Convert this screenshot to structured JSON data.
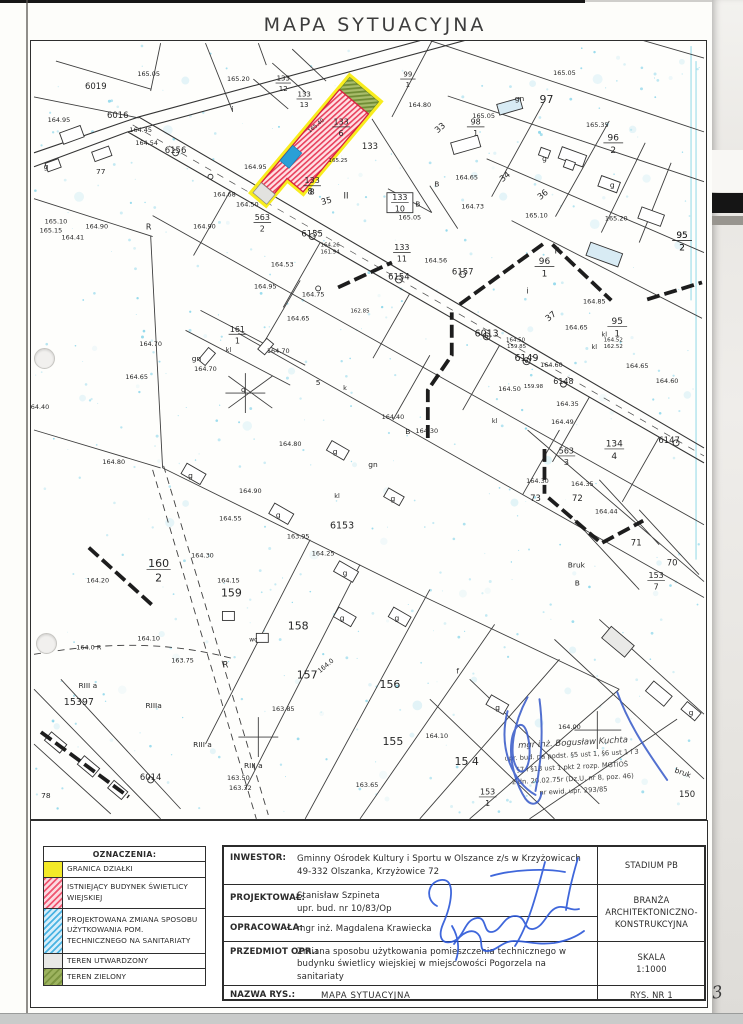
{
  "page": {
    "title": "MAPA SYTUACYJNA",
    "page_number": "3"
  },
  "legend": {
    "header": "OZNACZENIA:",
    "items": [
      {
        "label": "GRANICA DZIAŁKI",
        "swatch": "yellow",
        "color": "#f3e927"
      },
      {
        "label": "ISTNIEJĄCY BUDYNEK ŚWIETLICY WIEJSKIEJ",
        "swatch": "red",
        "color": "#ef5570"
      },
      {
        "label": "PROJEKTOWANA ZMIANA SPOSOBU UŻYTKOWANIA POM. TECHNICZNEGO NA SANITARIATY",
        "swatch": "blue",
        "color": "#4ab3e2"
      },
      {
        "label": "TEREN UTWARDZONY",
        "swatch": "gray",
        "color": "#e8e8e6"
      },
      {
        "label": "TEREN ZIELONY",
        "swatch": "green",
        "color": "#8fa750"
      }
    ]
  },
  "title_block": {
    "inwestor": {
      "label": "INWESTOR:",
      "line1": "Gminny Ośrodek Kultury i Sportu w Olszance z/s w Krzyżowicach",
      "line2": "49-332 Olszanka, Krzyżowice 72"
    },
    "stadium": "STADIUM PB",
    "projektowal": {
      "label": "PROJEKTOWAŁ:",
      "name": "Stanisław Szpineta",
      "upr": "upr. bud. nr 10/83/Op"
    },
    "opracowala": {
      "label": "OPRACOWAŁA:",
      "name": "mgr inż. Magdalena Krawiecka"
    },
    "branza": "BRANŻA\nARCHITEKTONICZNO-\nKONSTRUKCYJNA",
    "przedmiot": {
      "label": "PRZEDMIOT OPR.:",
      "value": "Zmiana sposobu użytkowania pomieszczenia technicznego w\nbudynku świetlicy wiejskiej w miejscowości Pogorzela na\nsanitariaty"
    },
    "skala": {
      "label": "SKALA",
      "value": "1:1000"
    },
    "nazwa": {
      "label": "NAZWA RYS.:",
      "value": "MAPA SYTUACYJNA"
    },
    "rys_nr": "RYS. NR 1"
  },
  "stamp": {
    "color": "#3a5cc4",
    "name": "mgr inż. Bogusław Kuchta",
    "lines": [
      "upr. bud. na podst. §5 ust 1, §6 ust 1 i 3",
      "§7 i §13 ust 1 pkt 2 rozp. MGTiOŚ",
      "z dn. 20.02.75r (Dz.U. nr 8, poz. 46)",
      "nr ewid. upr. 293/85"
    ]
  },
  "map": {
    "labels": [
      [
        "165.05",
        148,
        75,
        6.5
      ],
      [
        "165.20",
        238,
        80,
        6.5
      ],
      [
        "6019",
        95,
        88,
        8.5
      ],
      [
        "6016",
        117,
        117,
        8.5
      ],
      [
        "164.95",
        58,
        121,
        6.5
      ],
      [
        "164.45",
        140,
        131,
        6.5
      ],
      [
        "164.54",
        146,
        144,
        6.5
      ],
      [
        "6156",
        175,
        152,
        8.5
      ],
      [
        "164.95",
        255,
        168,
        6.5
      ],
      [
        "164.68",
        224,
        196,
        6.5
      ],
      [
        "164.50",
        247,
        206,
        6.5
      ],
      [
        "164.90",
        96,
        228,
        6.5
      ],
      [
        "R",
        148,
        229,
        8
      ],
      [
        "164.90",
        204,
        228,
        6.5
      ],
      [
        "165.10",
        55,
        223,
        6.5
      ],
      [
        "165.15",
        50,
        232,
        6.5
      ],
      [
        "164.41",
        72,
        239,
        6.5
      ],
      [
        "164.75",
        313,
        296,
        6.5
      ],
      [
        "164.95",
        265,
        288,
        6.5
      ],
      [
        "164.53",
        282,
        266,
        6.5
      ],
      [
        "6155",
        312,
        236,
        8.5
      ],
      [
        "B",
        418,
        206,
        7.5
      ],
      [
        "165.05",
        410,
        219,
        6.5
      ],
      [
        "8",
        310,
        194,
        8.5
      ],
      [
        "35",
        327,
        203,
        8.5,
        -15
      ],
      [
        "II",
        346,
        198,
        8.5
      ],
      [
        "164.26",
        330,
        246,
        5.5
      ],
      [
        "161.94",
        330,
        253,
        5.5
      ],
      [
        "165.40",
        317,
        126,
        5.5,
        -40
      ],
      [
        "133",
        370,
        148,
        8.5
      ],
      [
        "165.25",
        338,
        161,
        5.5
      ],
      [
        "i",
        232,
        111,
        8
      ],
      [
        "77",
        100,
        173,
        7.5
      ],
      [
        "g",
        45,
        168,
        7.5
      ],
      [
        "97",
        547,
        102,
        11
      ],
      [
        "gn",
        520,
        100,
        7.5
      ],
      [
        "165.05",
        484,
        117,
        6.5
      ],
      [
        "165.05",
        565,
        74,
        6.5
      ],
      [
        "33",
        442,
        129,
        8.5,
        -40
      ],
      [
        "165.35",
        598,
        126,
        6.5
      ],
      [
        "34",
        507,
        178,
        8.5,
        -40
      ],
      [
        "36",
        545,
        196,
        8.5,
        -40
      ],
      [
        "165.10",
        537,
        217,
        6.5
      ],
      [
        "165.20",
        617,
        220,
        6.5
      ],
      [
        "164.65",
        467,
        179,
        6.5
      ],
      [
        "164.73",
        473,
        208,
        6.5
      ],
      [
        "B",
        437,
        186,
        7.5
      ],
      [
        "164.80",
        420,
        106,
        6.5
      ],
      [
        "R",
        558,
        253,
        8.5
      ],
      [
        "i",
        528,
        293,
        8
      ],
      [
        "37",
        553,
        318,
        8.5,
        -40
      ],
      [
        "164.85",
        595,
        303,
        6.5
      ],
      [
        "164.65",
        577,
        329,
        6.5
      ],
      [
        "kl",
        605,
        336,
        6.5
      ],
      [
        "kl",
        595,
        349,
        6.5
      ],
      [
        "164.52",
        614,
        341,
        5.5
      ],
      [
        "162.52",
        614,
        348,
        5.5
      ],
      [
        "164.65",
        638,
        368,
        6.5
      ],
      [
        "164.60",
        668,
        383,
        6.5
      ],
      [
        "6013",
        487,
        336,
        9.5
      ],
      [
        "6149",
        527,
        361,
        9.5
      ],
      [
        "164.60",
        552,
        367,
        6.5
      ],
      [
        "164.50",
        516,
        341,
        5.5
      ],
      [
        "159.85",
        517,
        348,
        5.5
      ],
      [
        "164.50",
        510,
        391,
        6.5
      ],
      [
        "159.98",
        534,
        388,
        5.5
      ],
      [
        "6148",
        564,
        384,
        8
      ],
      [
        "164.35",
        568,
        406,
        6.5
      ],
      [
        "164.49",
        563,
        424,
        6.5
      ],
      [
        "164.40",
        393,
        419,
        6.5
      ],
      [
        "164.30",
        427,
        433,
        6.5
      ],
      [
        "kl",
        495,
        423,
        6.5
      ],
      [
        "B",
        408,
        434,
        7.5
      ],
      [
        "6154",
        399,
        279,
        8.5
      ],
      [
        "6157",
        463,
        274,
        8.5
      ],
      [
        "164.56",
        436,
        262,
        6.5
      ],
      [
        "6153",
        342,
        529,
        9.5
      ],
      [
        "163.95",
        298,
        539,
        6.5
      ],
      [
        "164.25",
        323,
        556,
        6.5
      ],
      [
        "164.30",
        202,
        558,
        6.5
      ],
      [
        "164.20",
        97,
        583,
        6.5
      ],
      [
        "164.15",
        228,
        583,
        6.5
      ],
      [
        "159",
        231,
        597,
        11
      ],
      [
        "158",
        298,
        630,
        11
      ],
      [
        "157",
        307,
        679,
        11
      ],
      [
        "156",
        390,
        689,
        11
      ],
      [
        "155",
        393,
        746,
        11
      ],
      [
        "15 4",
        467,
        766,
        11
      ],
      [
        "150",
        688,
        798,
        8.5
      ],
      [
        "bruk",
        683,
        776,
        7.5,
        20
      ],
      [
        "Bruk",
        577,
        568,
        7.5
      ],
      [
        "164.80",
        113,
        464,
        6.5
      ],
      [
        "164.80",
        290,
        446,
        6.5
      ],
      [
        "164.90",
        250,
        493,
        6.5
      ],
      [
        "164.55",
        230,
        521,
        6.5
      ],
      [
        "164.10",
        148,
        641,
        6.5
      ],
      [
        "164.0 R",
        88,
        650,
        6.5
      ],
      [
        "163.75",
        182,
        663,
        6.5
      ],
      [
        "R",
        225,
        668,
        8.5
      ],
      [
        "163.85",
        283,
        712,
        6.5
      ],
      [
        "RIII a",
        202,
        748,
        7.5
      ],
      [
        "RIII a",
        253,
        769,
        7.5
      ],
      [
        "RIII a",
        87,
        689,
        7.5
      ],
      [
        "RIIIa",
        153,
        709,
        7.5
      ],
      [
        "163.50",
        238,
        781,
        6.5
      ],
      [
        "163.32",
        240,
        791,
        6.5
      ],
      [
        "163.65",
        367,
        788,
        6.5
      ],
      [
        "164.10",
        437,
        739,
        6.5
      ],
      [
        "15397",
        78,
        706,
        9.5
      ],
      [
        "6014",
        150,
        781,
        8.5
      ],
      [
        "78",
        45,
        799,
        7.5
      ],
      [
        "164.00",
        570,
        730,
        6.5
      ],
      [
        "164.0",
        327,
        668,
        6.5,
        -40
      ],
      [
        "6147",
        670,
        443,
        8.5
      ],
      [
        "164.30",
        538,
        483,
        6.5
      ],
      [
        "164.35",
        583,
        486,
        6.5
      ],
      [
        "72",
        578,
        501,
        8.5
      ],
      [
        "73",
        536,
        501,
        8.5
      ],
      [
        "71",
        637,
        546,
        8.5
      ],
      [
        "70",
        673,
        566,
        8.5
      ],
      [
        "164.44",
        607,
        514,
        6.5
      ],
      [
        "B",
        578,
        586,
        7.5
      ],
      [
        "g",
        190,
        478,
        7.5
      ],
      [
        "g",
        278,
        518,
        7.5
      ],
      [
        "g",
        345,
        576,
        7.5
      ],
      [
        "g",
        342,
        621,
        7.5
      ],
      [
        "g",
        397,
        621,
        7.5
      ],
      [
        "g",
        335,
        454,
        7.5
      ],
      [
        "g",
        393,
        501,
        7.5
      ],
      [
        "g",
        498,
        711,
        7.5
      ],
      [
        "g",
        692,
        716,
        7.5
      ],
      [
        "g",
        613,
        187,
        7.5
      ],
      [
        "g",
        545,
        160,
        7.5
      ],
      [
        "f",
        458,
        674,
        7.5
      ],
      [
        "gn",
        373,
        467,
        7.5
      ],
      [
        "kl",
        337,
        498,
        6.5
      ],
      [
        "164.70",
        150,
        346,
        6.5
      ],
      [
        "164.65",
        136,
        379,
        6.5
      ],
      [
        "164.70",
        205,
        371,
        6.5
      ],
      [
        "gn",
        196,
        361,
        7.5
      ],
      [
        "kl",
        228,
        352,
        6.5
      ],
      [
        "164.70",
        278,
        353,
        6.5
      ],
      [
        "164.40",
        37,
        409,
        6.5
      ],
      [
        "164.65",
        298,
        320,
        6.5
      ],
      [
        "5",
        318,
        385,
        7.5
      ],
      [
        "k",
        345,
        390,
        6.5
      ],
      [
        "wc",
        253,
        642,
        6
      ],
      [
        "sil",
        262,
        640,
        0
      ],
      [
        "g",
        243,
        392,
        7.5
      ],
      [
        "162.85",
        360,
        312,
        5.5
      ]
    ],
    "fractions": [
      [
        "133",
        "10",
        400,
        202,
        8,
        true
      ],
      [
        "133",
        "11",
        402,
        252,
        8,
        false
      ],
      [
        "133",
        "8",
        312,
        185,
        8,
        false
      ],
      [
        "133",
        "6",
        341,
        126,
        8,
        false
      ],
      [
        "133",
        "13",
        304,
        98,
        7,
        false
      ],
      [
        "133",
        "12",
        283,
        82,
        7,
        false
      ],
      [
        "98",
        "1",
        476,
        126,
        8,
        false
      ],
      [
        "96",
        "2",
        614,
        142,
        9,
        false
      ],
      [
        "95",
        "2",
        683,
        240,
        9,
        false
      ],
      [
        "99",
        "1",
        408,
        78,
        7,
        false
      ],
      [
        "96",
        "1",
        545,
        266,
        9,
        false
      ],
      [
        "95",
        "1",
        618,
        326,
        9,
        false
      ],
      [
        "160",
        "2",
        158,
        570,
        11,
        false
      ],
      [
        "134",
        "4",
        615,
        449,
        9,
        false
      ],
      [
        "563",
        "3",
        567,
        456,
        8,
        false
      ],
      [
        "153",
        "7",
        657,
        581,
        8,
        false
      ],
      [
        "153",
        "1",
        488,
        798,
        8,
        false
      ],
      [
        "563",
        "2",
        262,
        222,
        8,
        false
      ],
      [
        "161",
        "1",
        237,
        334,
        8,
        false
      ],
      [
        "95",
        "2",
        683,
        240,
        9,
        false
      ]
    ]
  }
}
